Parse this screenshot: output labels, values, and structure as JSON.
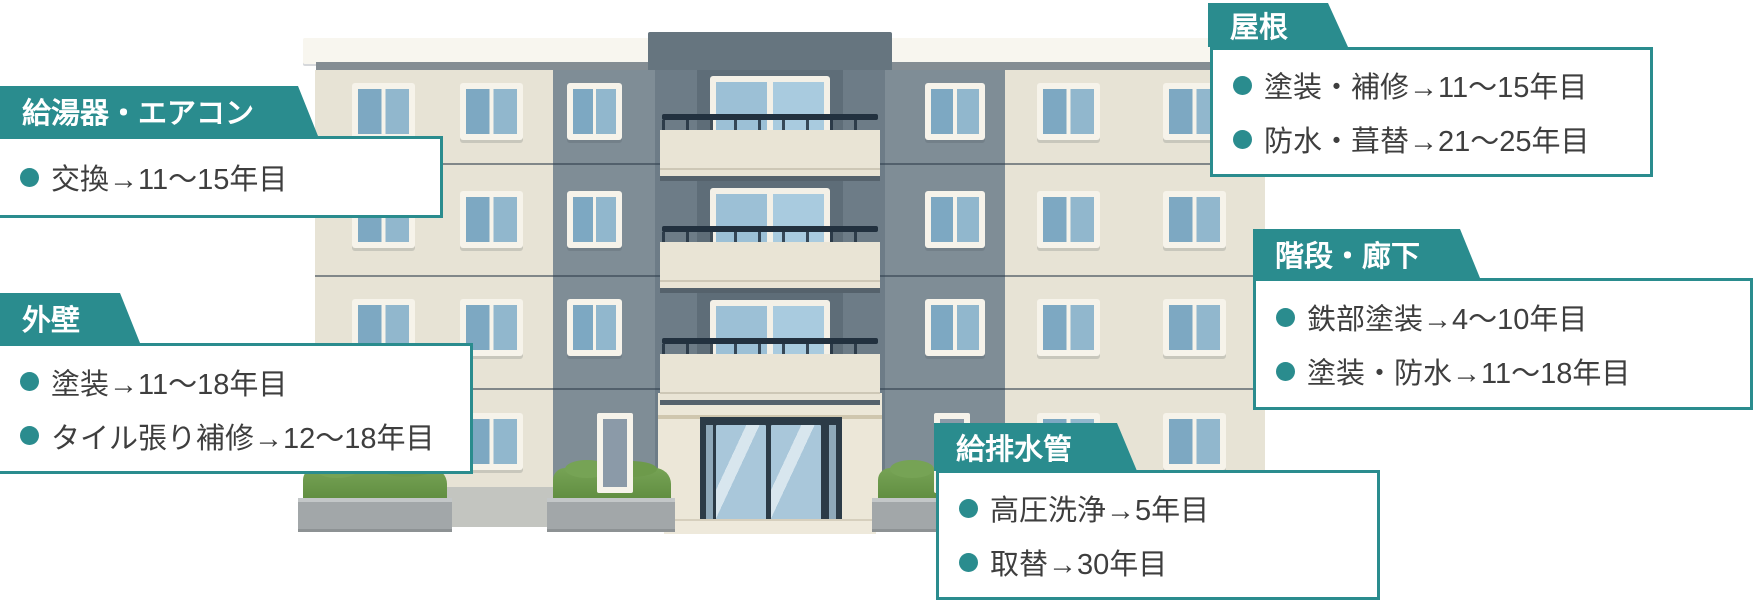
{
  "accent_color": "#2a8c8e",
  "text_color": "#3e3e3e",
  "illustration": {
    "type": "apartment-building",
    "floors": 4
  },
  "callouts": [
    {
      "id": "water-heater-aircon",
      "title": "給湯器・エアコン",
      "items": [
        "交換→11〜15年目"
      ]
    },
    {
      "id": "exterior-wall",
      "title": "外壁",
      "items": [
        "塗装→11〜18年目",
        "タイル張り補修→12〜18年目"
      ]
    },
    {
      "id": "roof",
      "title": "屋根",
      "items": [
        "塗装・補修→11〜15年目",
        "防水・葺替→21〜25年目"
      ]
    },
    {
      "id": "stairs-corridor",
      "title": "階段・廊下",
      "items": [
        "鉄部塗装→4〜10年目",
        "塗装・防水→11〜18年目"
      ]
    },
    {
      "id": "plumbing",
      "title": "給排水管",
      "items": [
        "高圧洗浄→5年目",
        "取替→30年目"
      ]
    }
  ]
}
